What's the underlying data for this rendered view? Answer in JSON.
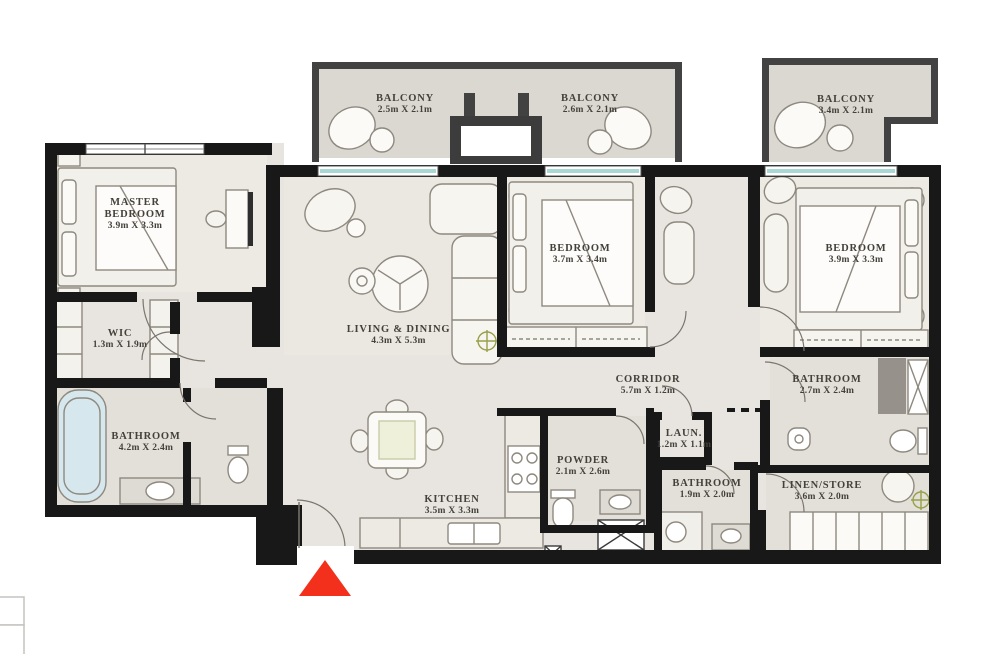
{
  "plan": {
    "type": "apartment-floor-plan",
    "rooms": [
      {
        "id": "master-bedroom",
        "name": "MASTER BEDROOM",
        "dims": "3.9m X 3.3m"
      },
      {
        "id": "balcony-1",
        "name": "BALCONY",
        "dims": "2.5m X 2.1m"
      },
      {
        "id": "balcony-2",
        "name": "BALCONY",
        "dims": "2.6m X 2.1m"
      },
      {
        "id": "balcony-3",
        "name": "BALCONY",
        "dims": "3.4m X 2.1m"
      },
      {
        "id": "bedroom-2",
        "name": "BEDROOM",
        "dims": "3.7m X 3.4m"
      },
      {
        "id": "bedroom-3",
        "name": "BEDROOM",
        "dims": "3.9m X 3.3m"
      },
      {
        "id": "wic",
        "name": "WIC",
        "dims": "1.3m X 1.9m"
      },
      {
        "id": "living-dining",
        "name": "LIVING & DINING",
        "dims": "4.3m X 5.3m"
      },
      {
        "id": "corridor",
        "name": "CORRIDOR",
        "dims": "5.7m X 1.2m"
      },
      {
        "id": "master-bathroom",
        "name": "BATHROOM",
        "dims": "4.2m X 2.4m"
      },
      {
        "id": "bathroom-2",
        "name": "BATHROOM",
        "dims": "2.7m X 2.4m"
      },
      {
        "id": "powder",
        "name": "POWDER",
        "dims": "2.1m X 2.6m"
      },
      {
        "id": "laundry",
        "name": "LAUN.",
        "dims": "1.2m X 1.1m"
      },
      {
        "id": "bathroom-3",
        "name": "BATHROOM",
        "dims": "1.9m X 2.0m"
      },
      {
        "id": "linen-store",
        "name": "LINEN/STORE",
        "dims": "3.6m X 2.0m"
      },
      {
        "id": "kitchen",
        "name": "KITCHEN",
        "dims": "3.5m X 3.3m"
      }
    ],
    "entrance": {
      "marker": "red-triangle",
      "color": "#f2301c"
    },
    "colors": {
      "wall": "#181818",
      "balcony_wall": "#424242",
      "floor": "#e8e5e0",
      "room_floor": "#edeae4",
      "bath_floor": "#e3e0d9",
      "balcony_floor": "#dbd8d2",
      "glass": "#a9d8d4",
      "bathtub": "#d6e7ed",
      "label_text": "#44403a"
    }
  }
}
